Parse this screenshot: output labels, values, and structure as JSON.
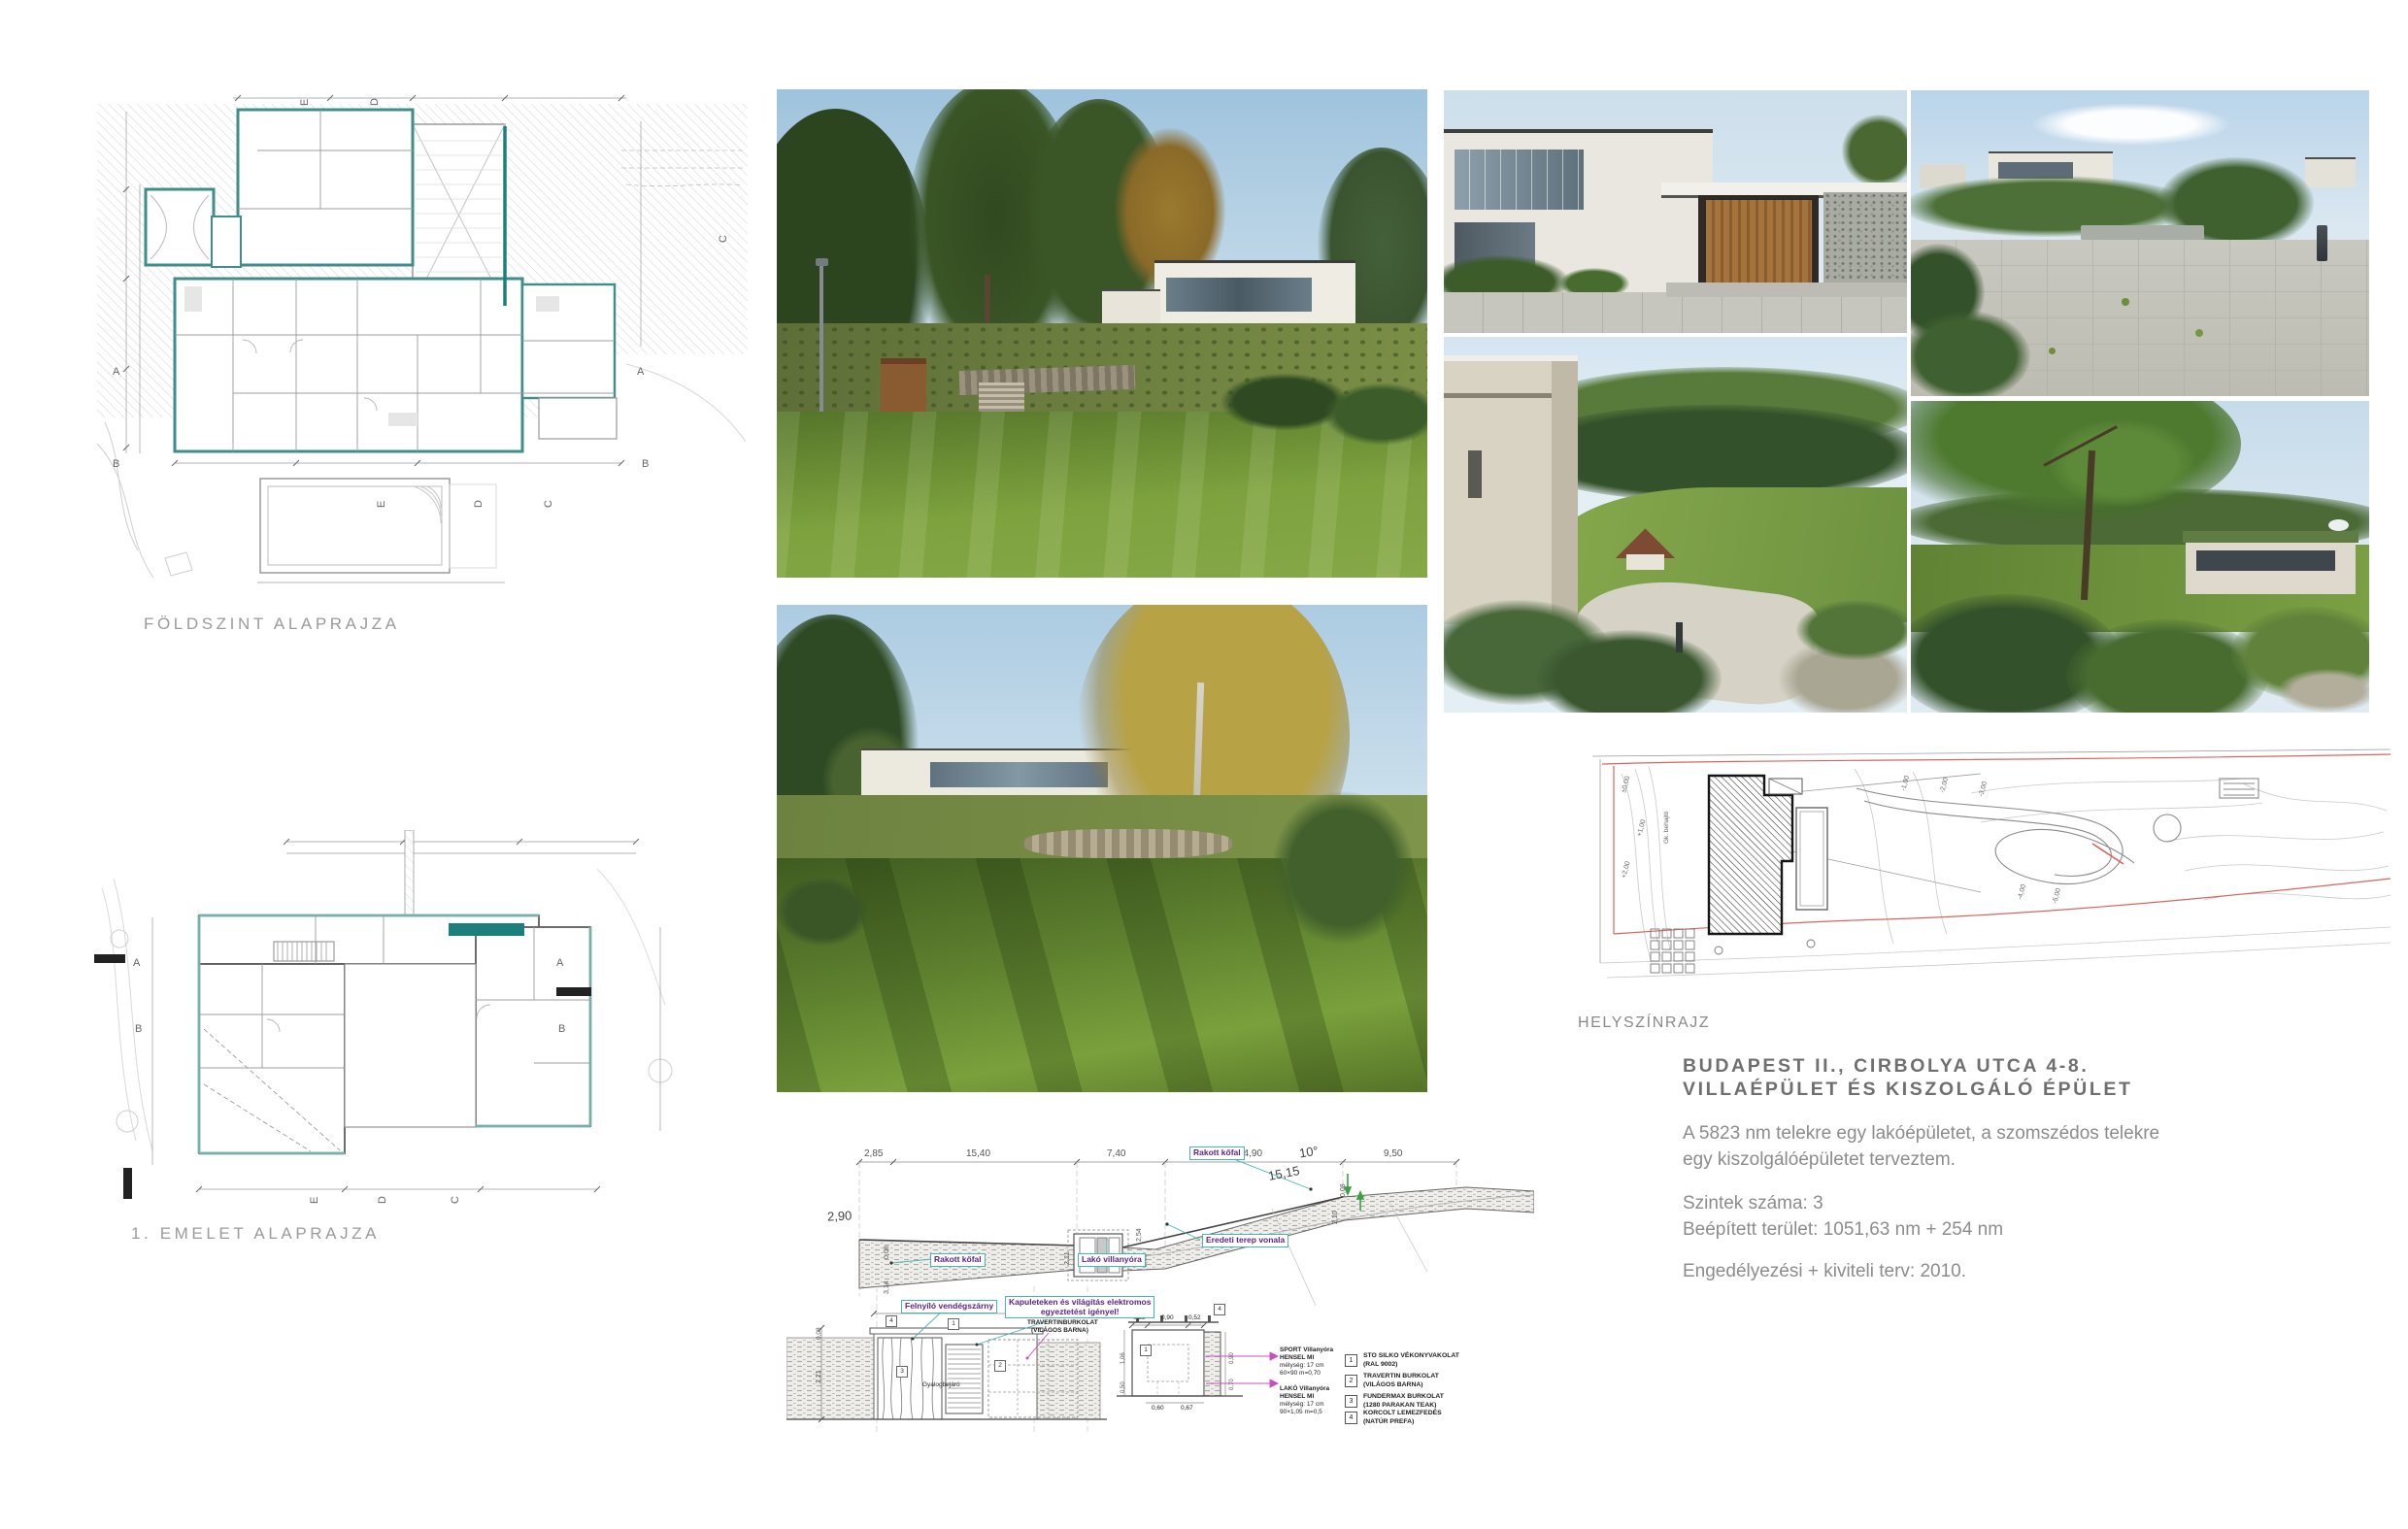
{
  "labels": {
    "ground_floor": "FÖLDSZINT ALAPRAJZA",
    "first_floor": "1. EMELET  ALAPRAJZA",
    "site_plan": "HELYSZÍNRAJZ"
  },
  "project": {
    "title1": "BUDAPEST II., CIRBOLYA UTCA 4-8.",
    "title2": "VILLAÉPÜLET ÉS KISZOLGÁLÓ ÉPÜLET",
    "desc1": "A 5823 nm telekre egy lakóépületet, a szomszédos telekre",
    "desc2": "egy kiszolgálóépületet terveztem.",
    "levels": "Szintek száma: 3",
    "area": "Beépített terület: 1051,63 nm + 254 nm",
    "permit": "Engedélyezési + kiviteli terv: 2010."
  },
  "grid": {
    "a": "A",
    "b": "B",
    "c": "C",
    "d": "D",
    "e": "E"
  },
  "section": {
    "d1": "2,85",
    "d2": "15,40",
    "d3": "7,40",
    "d4": "14,90",
    "d5": "9,50",
    "lvl": "2,90",
    "ang": "10°",
    "slen": "15,15",
    "v1": "0,08",
    "v2": "3,14",
    "v3": "2,21",
    "v4": "2,54",
    "v5": "2,16",
    "v6": "2,08",
    "v7": "2,10",
    "v8": "0,08",
    "co_stone": "Rakott kőfal",
    "co_meter": "Lakó villanyóra",
    "co_terrain": "Eredeti terep vonala"
  },
  "gate": {
    "w": "4,45",
    "v1": "0,08",
    "v2": "2,21",
    "co_wing": "Felnyíló vendégszárny",
    "co_el1": "Kapuleteken és világítás elektromos",
    "co_el2": "egyeztetést igényel!",
    "trav1": "TRAVERTINBURKOLAT",
    "trav2": "(VILÁGOS BARNA)",
    "walk": "Gyalogbejáró",
    "t1": "1",
    "t2": "2",
    "t3": "3",
    "t4": "4"
  },
  "pillar": {
    "a1": "0,52",
    "a2": "0,90",
    "a3": "0,52",
    "l1": "1,06",
    "l2": "0,50",
    "r1": "0,90",
    "r2": "0,70",
    "b1": "0,60",
    "b2": "0,67"
  },
  "meters": {
    "sport": [
      "SPORT Villanyóra",
      "HENSEL MI",
      "mélység: 17 cm",
      "60×90 m=0,70"
    ],
    "lako": [
      "LAKÓ Villanyóra",
      "HENSEL MI",
      "mélység: 17 cm",
      "90×1,05 m=0,5"
    ]
  },
  "legend": {
    "items": [
      {
        "num": "1",
        "l1": "STO SILKO VÉKONYVAKOLAT",
        "l2": "(RAL 9002)"
      },
      {
        "num": "2",
        "l1": "TRAVERTIN BURKOLAT",
        "l2": "(VILÁGOS BARNA)"
      },
      {
        "num": "3",
        "l1": "FUNDERMAX BURKOLAT",
        "l2": "(1280 PARAKAN TEAK)"
      },
      {
        "num": "4",
        "l1": "KORCOLT LEMEZFEDÉS",
        "l2": "(NATÚR PREFA)"
      }
    ]
  },
  "site": {
    "l1": "±0,00",
    "l2": "+1,00",
    "l3": "+2,00",
    "l4": "-1,00",
    "l5": "-2,00",
    "l6": "-3,00",
    "l7": "-4,00",
    "l8": "-5,00",
    "drive": "Gk. behajtó"
  },
  "colors": {
    "accent_teal": "#3f8e89",
    "accent_teal_dark": "#1d7f7c",
    "wall_teal_light": "#d9eeec",
    "callout_purple": "#5c2483",
    "callout_cyan": "#4ab5b5",
    "red_boundary": "#d96560",
    "magenta_arrow": "#c84fc0",
    "label_gray": "#9b9b9b",
    "title_gray": "#6f6f6f",
    "body_gray": "#8c8c8c"
  }
}
